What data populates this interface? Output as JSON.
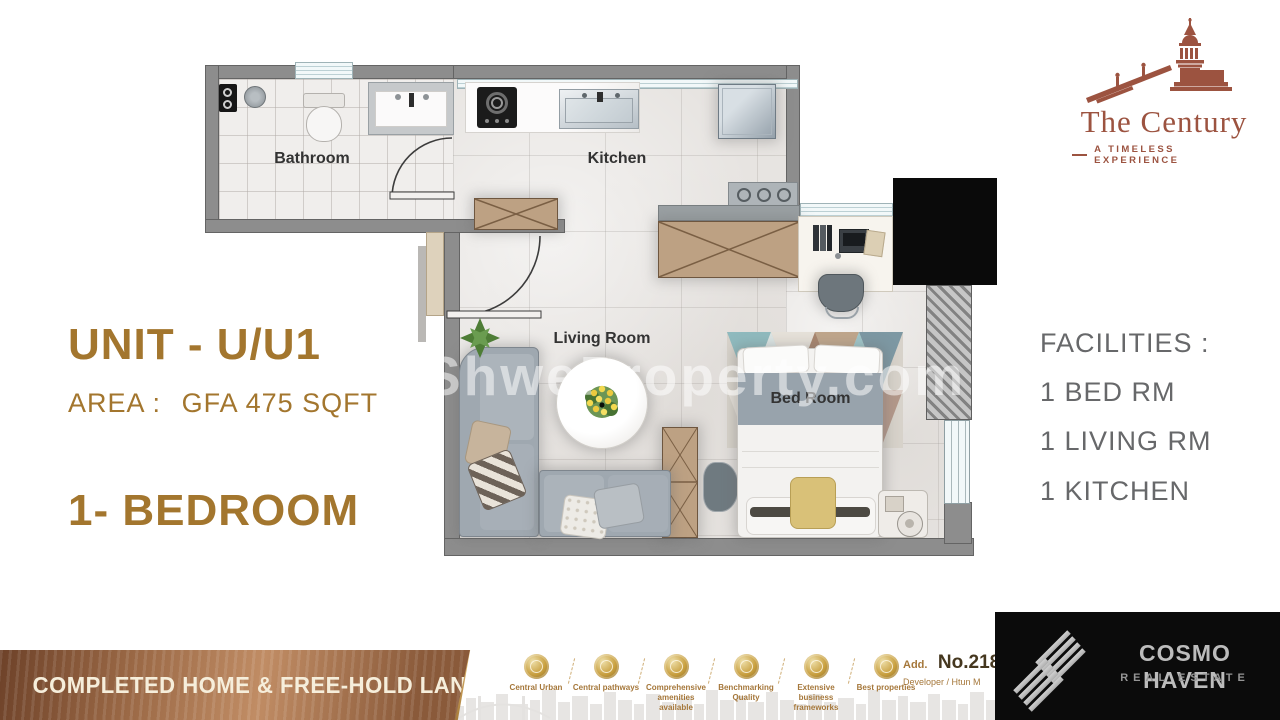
{
  "branding": {
    "century": {
      "title": "The Century",
      "tagline": "A TIMELESS EXPERIENCE"
    },
    "watermark": "ShweProperty.com",
    "cosmo": {
      "name": "COSMO HAVEN",
      "subtitle": "REAL ESTATE"
    }
  },
  "unit": {
    "title": "UNIT - U/U1",
    "area_label": "AREA :",
    "area_value": "GFA 475 SQFT",
    "type": "1- BEDROOM"
  },
  "facilities": {
    "heading": "FACILITIES :",
    "items": [
      "1 BED RM",
      "1 LIVING RM",
      "1 KITCHEN"
    ]
  },
  "floor_plan": {
    "rooms": [
      {
        "name": "Bathroom"
      },
      {
        "name": "Kitchen"
      },
      {
        "name": "Living Room"
      },
      {
        "name": "Bed Room"
      }
    ]
  },
  "footer": {
    "banner": "COMPLETED HOME & FREE-HOLD LAND",
    "features": [
      {
        "label": "Central Urban",
        "icon": "urban-coin-icon"
      },
      {
        "label": "Central pathways",
        "icon": "pathways-coin-icon"
      },
      {
        "label": "Comprehensive amenities available",
        "icon": "amenities-coin-icon"
      },
      {
        "label": "Benchmarking Quality",
        "icon": "quality-coin-icon"
      },
      {
        "label": "Extensive business frameworks",
        "icon": "business-coin-icon"
      },
      {
        "label": "Best properties",
        "icon": "properties-coin-icon"
      }
    ],
    "address_label": "Add.",
    "address_no": "No.218",
    "developer": "Developer / Htun M"
  },
  "colors": {
    "brand_gold": "#a3762e",
    "century_brown": "#9c5340",
    "facilities_gray": "#68696b",
    "banner_copper": "#a06a44",
    "coin_gold": "#c89f3f",
    "wall_gray": "#8d8d8d",
    "sofa_gray": "#9fa8b0",
    "wood": "#bda183"
  }
}
